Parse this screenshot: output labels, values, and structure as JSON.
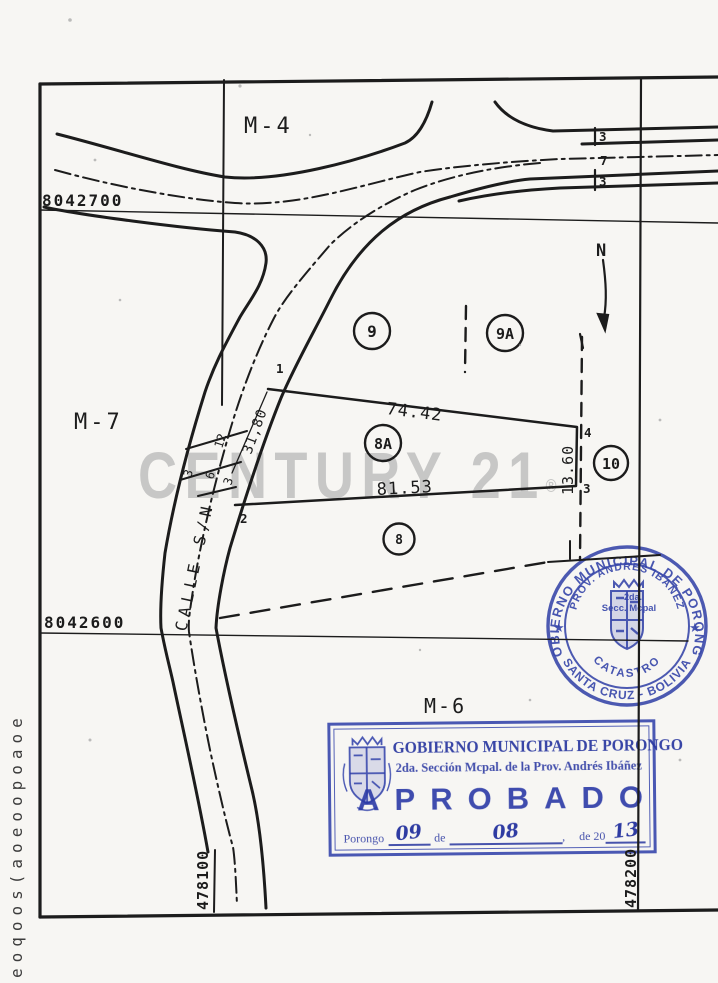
{
  "map": {
    "block_labels": {
      "top": "M-4",
      "left": "M-7",
      "bottom": "M-6"
    },
    "grid_coordinates": {
      "north_upper": "8042700",
      "north_lower": "8042600",
      "east_left": "478100",
      "east_right": "478200"
    },
    "street": {
      "name": "CALLE S/N"
    },
    "north_arrow_label": "N",
    "parcels": [
      {
        "id": "9"
      },
      {
        "id": "9A"
      },
      {
        "id": "8A"
      },
      {
        "id": "10"
      },
      {
        "id": "8"
      }
    ],
    "vertex_labels": {
      "v1": "1",
      "v2": "2",
      "v3": "3",
      "v4": "4"
    },
    "dimensions": {
      "edge_1_4": "74.42",
      "edge_2_3": "81.53",
      "edge_3_4": "13.60",
      "road_frontage": "31,80",
      "tick_12": "12",
      "tick_3a": "3",
      "tick_6": "6",
      "tick_3b": "3",
      "road_width_top": "3",
      "road_width_mid": "7",
      "road_width_bottom": "3"
    }
  },
  "watermark": {
    "text": "CENTURY 21",
    "registered": "®",
    "color": "#bfbfbf"
  },
  "stamps": {
    "round": {
      "ring_top": "GOBIERNO MUNICIPAL DE PORONGO",
      "ring_bottom": "SANTA CRUZ - BOLIVIA",
      "star_left": "★",
      "star_right": "★",
      "inner_arc": "PROV. ANDRES IBAÑEZ",
      "line_1": "2da.",
      "line_2": "Secc. Mcpal",
      "inner_bottom_arc": "CATASTRO",
      "ink": "#3848aa"
    },
    "approval": {
      "title": "GOBIERNO MUNICIPAL DE PORONGO",
      "subtitle": "2da. Sección Mcpal. de la Prov. Andrés Ibáñez",
      "status": "APROBADO",
      "place": "Porongo",
      "day": "09",
      "de_word": "de",
      "month": "08",
      "comma": ",",
      "de_20": "de 20",
      "year": "13",
      "ink": "#2c3ca8"
    }
  },
  "left_margin": {
    "vertical_text": "eoqoos(aoeoopoaoe"
  }
}
